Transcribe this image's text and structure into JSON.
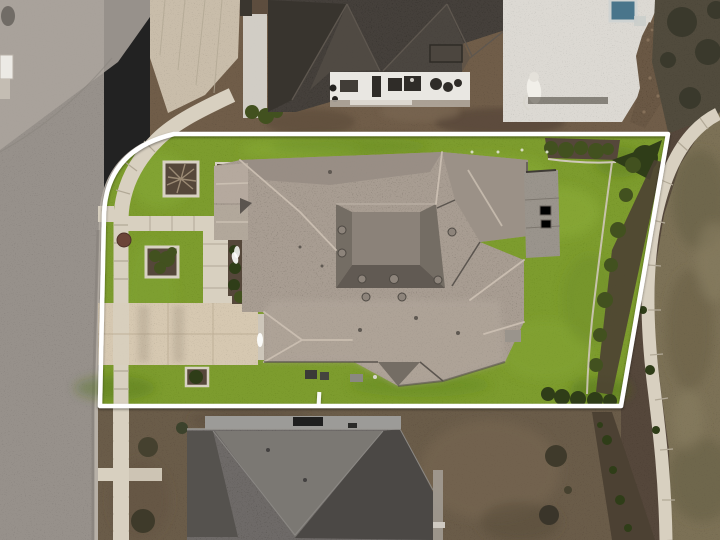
{
  "image": {
    "type": "aerial-drone-photo",
    "description": "Overhead aerial photo of a single-family home lot outlined with a white property boundary, street at left, neighboring houses above and below, green lawn, driveway, sidewalks and landscaping",
    "width": 720,
    "height": 540
  },
  "boundary": {
    "path": "M 100 406 L 104 215 Q 106 150 174 134 L 668 134 L 621 406 Z",
    "stroke_width": 4.5,
    "tick_x": 317
  },
  "scene": [
    "street",
    "curb",
    "mail-kiosk",
    "neighbor-driveway-apron",
    "top-neighbor-house",
    "top-neighbor-patio",
    "pool",
    "pool-deck",
    "fountain",
    "rock-garden-bed",
    "scrub-trees",
    "right-sidewalk",
    "brown-lawn",
    "property-boundary",
    "front-lawn",
    "back-lawn",
    "public-sidewalk",
    "front-walkway",
    "driveway",
    "planting-beds",
    "main-house-roof",
    "roof-vents",
    "rear-patio-slab",
    "ac-units",
    "garage-door",
    "border-bed",
    "hedge",
    "bottom-parkway",
    "bottom-neighbor-house"
  ],
  "colors": {
    "street": "#97918b",
    "street_light": "#aca59d",
    "street_dark": "#87827c",
    "curb": "#b7b0a7",
    "sidewalk": "#d8d0c0",
    "sidewalk_joint": "#b2a997",
    "driveway": "#d6c8b1",
    "driveway_shade": "#c8baa3",
    "grass": "#6f9222",
    "grass_light": "#8cb13a",
    "grass_dark": "#4f701c",
    "back_grass": "#7d9c2f",
    "roof": "#a89d92",
    "roof_light": "#b7aca0",
    "roof_dark": "#746d64",
    "roof_mid": "#8b8279",
    "roof_channel": "#615a53",
    "ridge": "#cfc3b5",
    "valley": "#5b554f",
    "patio_slab": "#9a948c",
    "nt_roof": "#45403a",
    "nt_dark": "#38342e",
    "nt_light": "#524c45",
    "patio_white": "#e9e7e2",
    "deck_white": "#dcd9d3",
    "pool": "#49758b",
    "dirt": "#6f5d49",
    "dirt_bottom": "#6b5c48",
    "mulch": "#55473a",
    "mulch_dark": "#4c4133",
    "rock_bed": "#6a5844",
    "brown_lawn": "#7b7157",
    "brown_dark": "#645b43",
    "brown_light": "#8b8164",
    "scrub": "#514b3d",
    "tree_dark": "#3a392c",
    "shrub": "#42511f",
    "shrub_dark": "#2f3d18",
    "nb_roof": "#6e6b67",
    "nb_dark": "#55524e",
    "nb_darker": "#4b4845",
    "nb_mid": "#7b7873",
    "nb_ridge": "#9c9b98",
    "wall_light": "#a9a49c",
    "garage": "#cdc6ba",
    "utility": "#6b4438",
    "white": "#f2f0ea",
    "boundary": "#ffffff",
    "vent_fill": "#8d847b",
    "vent_rim": "#4e4943",
    "panel_dark": "#1f1f1f"
  }
}
